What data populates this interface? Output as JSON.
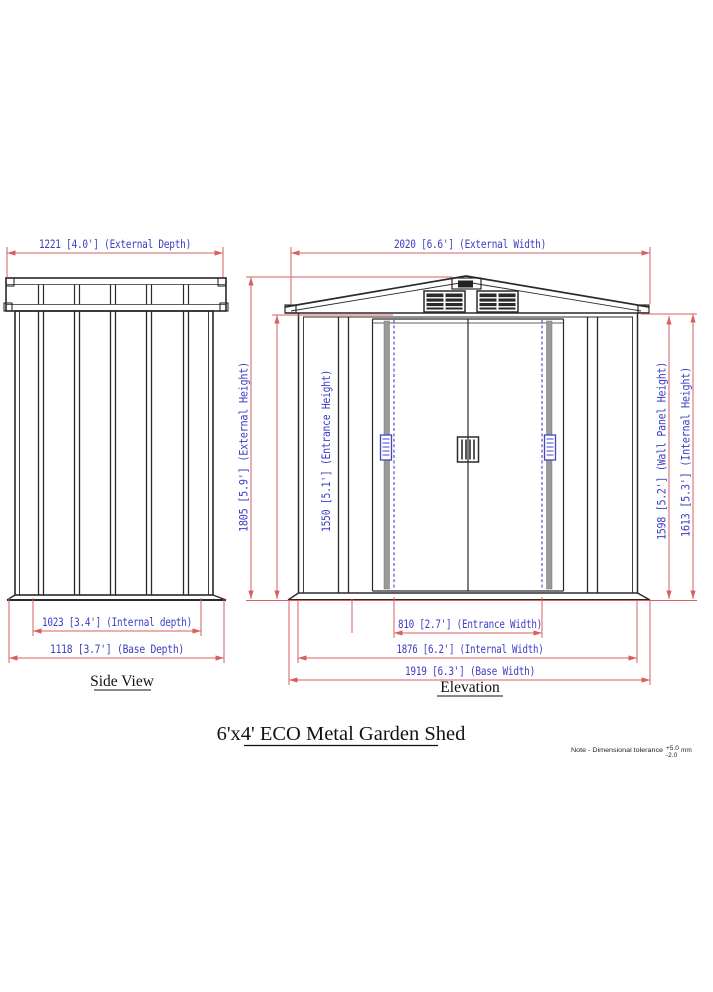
{
  "title": "6'x4' ECO Metal Garden Shed",
  "side_view": {
    "label": "Side View",
    "external_depth": "1221 [4.0'] (External Depth)",
    "internal_depth": "1023 [3.4'] (Internal depth)",
    "base_depth": "1118 [3.7'] (Base Depth)"
  },
  "elevation": {
    "label": "Elevation",
    "external_width": "2020 [6.6'] (External Width)",
    "external_height": "1805 [5.9'] (External Height)",
    "entrance_height": "1550 [5.1'] (Entrance Height)",
    "wall_panel_height": "1598 [5.2'] (Wall Panel Height)",
    "internal_height": "1613 [5.3'] (Internal Height)",
    "entrance_width": "810 [2.7'] (Entrance Width)",
    "internal_width": "1876 [6.2'] (Internal Width)",
    "base_width": "1919 [6.3'] (Base Width)"
  },
  "note": {
    "text": "Note  -  Dimensional tolerance",
    "tolerance_plus": "+5.0",
    "tolerance_minus": "-2.0",
    "unit": "mm"
  },
  "colors": {
    "dimension_line": "#d95f5f",
    "dimension_text": "#3c3cc4",
    "drawing_line": "#2a2a2a",
    "door_accent_blue": "#4343c8"
  }
}
